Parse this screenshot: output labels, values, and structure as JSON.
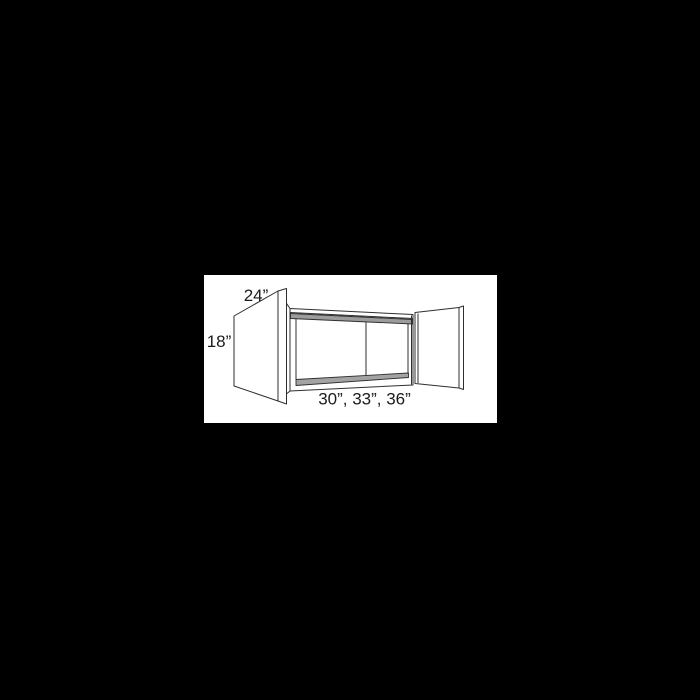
{
  "page": {
    "background_color": "#000000"
  },
  "figure": {
    "name": "wall-cabinet-dimension-diagram",
    "description": "Line drawing of a two-door wall cabinet shown with both doors open",
    "canvas": {
      "background_color": "#ffffff"
    },
    "colors": {
      "line": "#2f2f2f",
      "shade_top": "#9c9c9c",
      "shade_floor": "#a3a3a3"
    },
    "labels": {
      "depth": "24”",
      "height": "18”",
      "widths": "30”, 33”, 36”"
    }
  }
}
